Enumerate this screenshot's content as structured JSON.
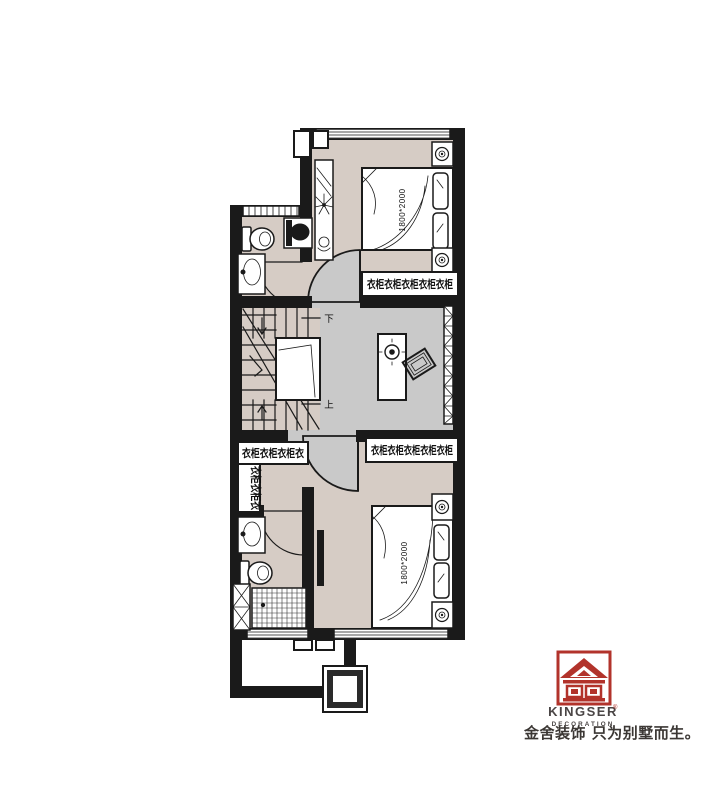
{
  "floorplan": {
    "bed_top": {
      "label": "1800*2000"
    },
    "bed_bottom": {
      "label": "1800*2000"
    },
    "stairs": {
      "down": "下",
      "up": "上"
    },
    "wardrobes": {
      "top": "衣柜衣柜衣柜衣柜衣柜",
      "bottom": "衣柜衣柜衣柜衣柜衣柜",
      "closet_h": "衣柜衣柜衣柜衣",
      "closet_v": "衣柜衣柜衣"
    },
    "colors": {
      "wall": "#1a1a1a",
      "bedroom_floor": "#d6ccc5",
      "hall_floor": "#c9c9c9",
      "fixture_white": "#ffffff"
    }
  },
  "branding": {
    "brand": "KINGSER",
    "registered": "®",
    "subtitle": "DECORATION",
    "tagline": "金舍装饰 只为别墅而生。",
    "logo_red": "#b2332b",
    "text_color": "#4a4545"
  }
}
